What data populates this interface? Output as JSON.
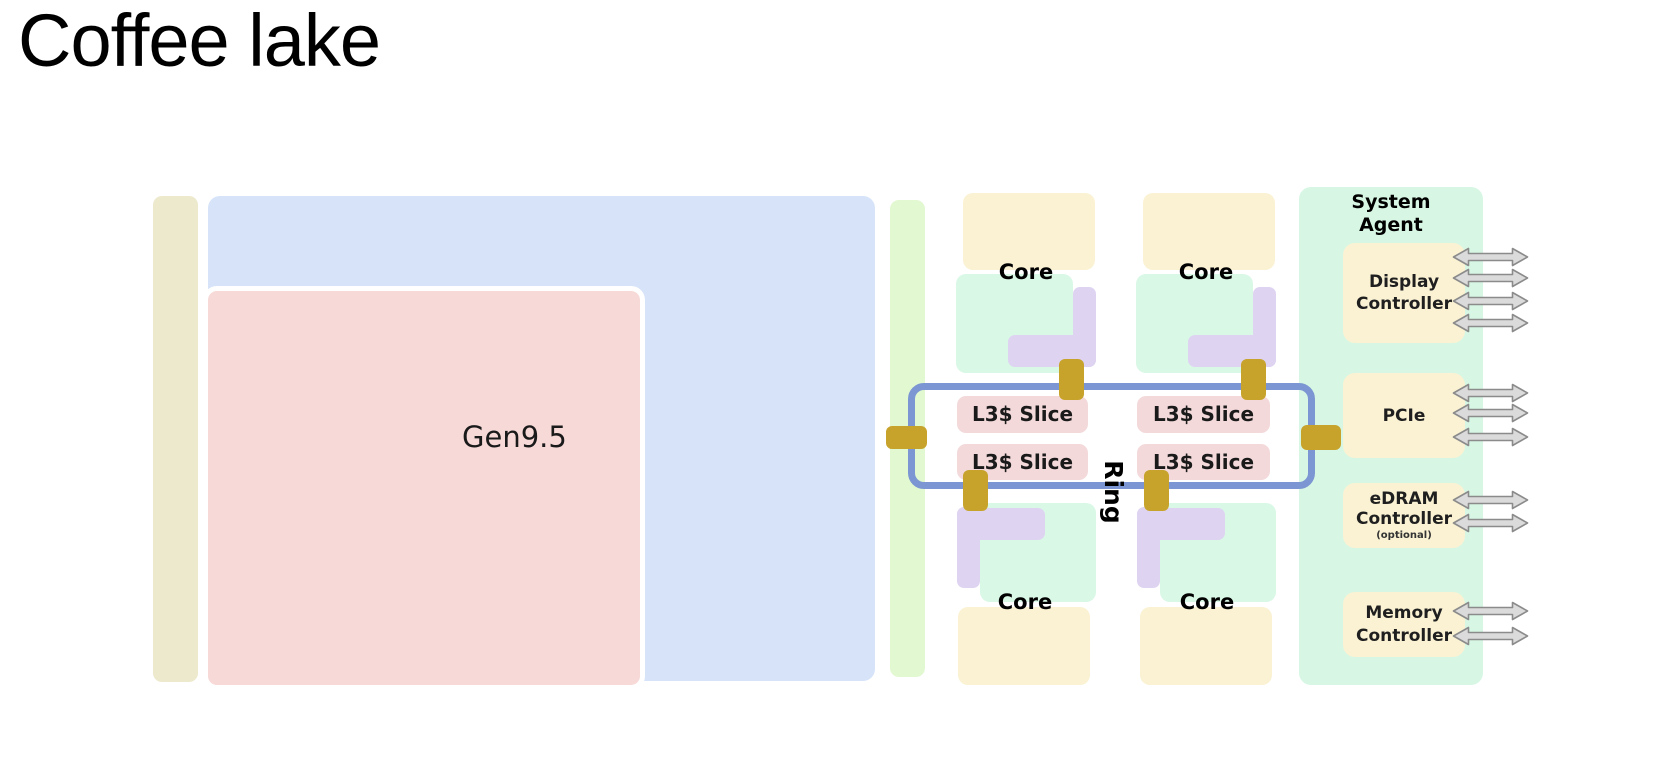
{
  "title": "Coffee lake",
  "gpu": {
    "label": "Gen9.5"
  },
  "core": {
    "label": "Core",
    "count": 4
  },
  "l3": {
    "label": "L3$ Slice",
    "count": 4
  },
  "ring": {
    "label": "Ring",
    "stop_count": 6
  },
  "system_agent": {
    "title": "System Agent",
    "display": {
      "label": "Display Controller",
      "arrow_count": 4
    },
    "pcie": {
      "label": "PCIe",
      "arrow_count": 3
    },
    "edram": {
      "label": "eDRAM Controller",
      "note": "(optional)",
      "arrow_count": 2
    },
    "memory": {
      "label": "Memory Controller",
      "arrow_count": 2
    }
  },
  "colors": {
    "beige_strip": "#ede9cc",
    "blue_block": "#d6e3f8",
    "gpu_pink": "#f7d9d7",
    "green_strip": "#e2f8d1",
    "core_mint": "#d9f8e6",
    "core_purple": "#ded4f2",
    "core_cream": "#faf2d3",
    "l3_pink": "#f3d9da",
    "ring_blue": "#7b96d2",
    "ring_stop_gold": "#c7a32c",
    "system_agent_mint": "#d7f7e4",
    "arrow_fill": "#dcdbdc",
    "arrow_stroke": "#8b8b8b",
    "text": "#141414"
  }
}
